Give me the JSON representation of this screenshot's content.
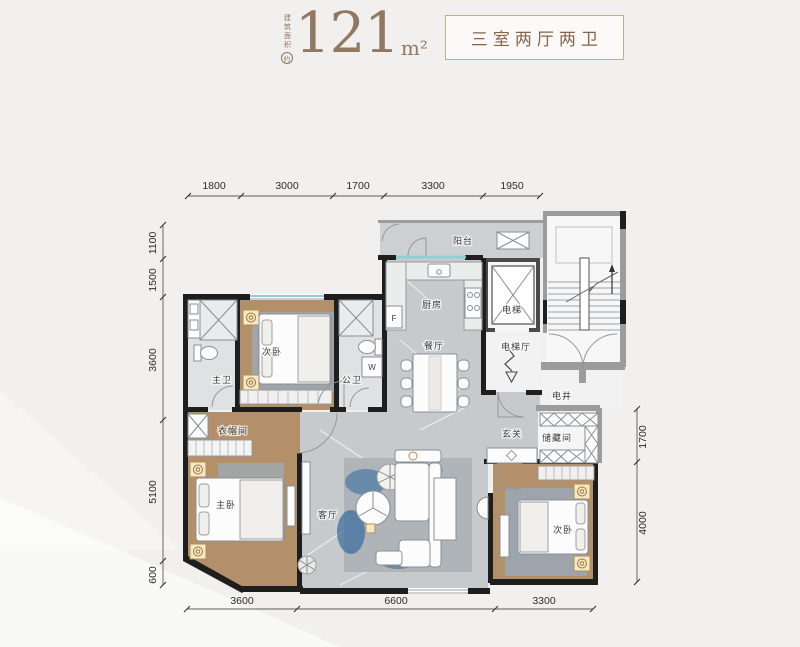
{
  "header": {
    "area_note_vertical": "建筑面积",
    "area_note_circle": "约",
    "area_value": "121",
    "area_unit": "m²",
    "layout_type": "三室两厅两卫"
  },
  "rooms": {
    "balcony": "阳台",
    "kitchen": "厨房",
    "dining": "餐厅",
    "elevator": "电梯",
    "elevator_hall": "电梯厅",
    "shaft": "电井",
    "bedroom2": "次卧",
    "bath_master": "主卫",
    "bath_public": "公卫",
    "cloakroom": "衣帽间",
    "bedroom_master": "主卧",
    "living": "客厅",
    "foyer": "玄关",
    "storage": "储藏间",
    "bedroom3": "次卧"
  },
  "appliances": {
    "fridge": "F",
    "washer": "W"
  },
  "dimensions": {
    "top": [
      "1800",
      "3000",
      "1700",
      "3300",
      "1950"
    ],
    "left": [
      "1100",
      "1500",
      "3600",
      "5100",
      "600"
    ],
    "right": [
      "1700",
      "4000"
    ],
    "bottom": [
      "3600",
      "6600",
      "3300"
    ]
  },
  "colors": {
    "accent_brown": "#917863",
    "box_border": "#c6ac8e",
    "wood_floor": "#b3906a",
    "marble_floor": "#c7cacc",
    "wall_black": "#1e1e1e",
    "gold_accent": "#b3914e",
    "window_teal": "#8ecfd8"
  }
}
